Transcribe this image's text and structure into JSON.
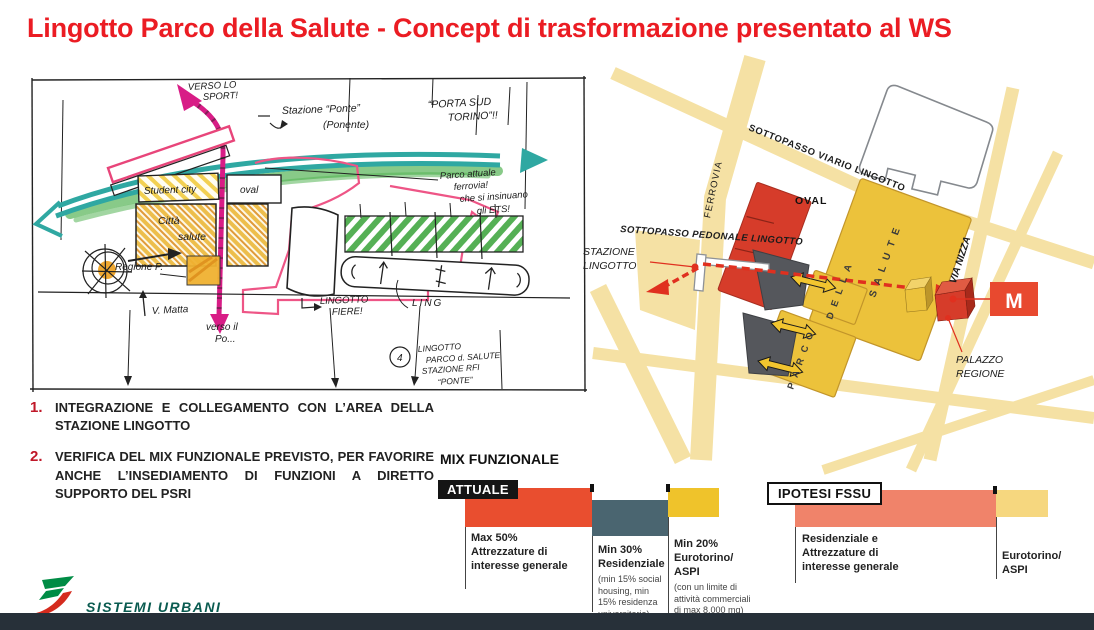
{
  "title": {
    "text": "Lingotto Parco della Salute - Concept di trasformazione presentato al WS",
    "color": "#EB1C23"
  },
  "sketch": {
    "labels": {
      "verso_sport_1": "VERSO LO",
      "verso_sport_2": "SPORT!",
      "stazione_ponte": "Stazione “Ponte”",
      "ponente": "(Ponente)",
      "porta_sud_1": "“PORTA SUD",
      "porta_sud_2": "TORINO”!!",
      "student_city": "Student city",
      "oval": "oval",
      "citta_1": "Città",
      "citta_2": "salute",
      "regione": "Regione P.",
      "parco_note_1": "Parco attuale",
      "parco_note_2": "ferrovia!",
      "parco_note_3": "che si insinuano",
      "parco_note_4": "gli ETS!",
      "v_matta": "V. Matta",
      "verso_po_1": "verso il",
      "verso_po_2": "Po...",
      "fiere_1": "LINGOTTO",
      "fiere_2": "FIERE!",
      "ling": "LING",
      "note_num": "4",
      "note_1": "LINGOTTO",
      "note_2": "PARCO d. SALUTE",
      "note_3": "STAZIONE RFI",
      "note_4": "“PONTE”"
    }
  },
  "map": {
    "labels": {
      "sottopasso_viario": "SOTTOPASSO VIARIO LINGOTTO",
      "ferrovia": "FERROVIA",
      "sottopasso_pedonale": "SOTTOPASSO PEDONALE LINGOTTO",
      "stazione_1": "STAZIONE",
      "stazione_2": "LINGOTTO",
      "oval": "OVAL",
      "salute": "S A L U T E",
      "della": "D E L L A",
      "parco": "P A R C O",
      "via_nizza": "VIA NIZZA",
      "metro": "M",
      "palazzo_1": "PALAZZO",
      "palazzo_2": "REGIONE"
    },
    "colors": {
      "building_yellow": "#ECC23B",
      "road_yellow": "#F5E1A4",
      "block_red": "#D63C2A",
      "block_gray": "#55575C",
      "metro_red": "#E8492F",
      "route_red": "#E0301F"
    }
  },
  "notes": {
    "items": [
      {
        "num": "1.",
        "text": "INTEGRAZIONE E COLLEGAMENTO CON L’AREA DELLA STAZIONE LINGOTTO"
      },
      {
        "num": "2.",
        "text": "VERIFICA DEL MIX FUNZIONALE PREVISTO, PER FAVORIRE ANCHE L’INSEDIAMENTO DI FUNZIONI A DIRETTO SUPPORTO DEL PSRI"
      }
    ]
  },
  "mix": {
    "heading": "MIX FUNZIONALE",
    "attuale": {
      "tag": "ATTUALE",
      "bars": [
        {
          "name": "attrezzature",
          "color": "#E94E2F",
          "value": 50,
          "bold": "Max 50%\nAttrezzature di\ninteresse generale",
          "sub": ""
        },
        {
          "name": "residenziale",
          "color": "#4A6570",
          "value": 30,
          "bold": "Min 30%\nResidenziale",
          "sub": "(min 15% social\nhousing, min\n15% residenza\nuniversitaria)"
        },
        {
          "name": "eurotorino-aspi",
          "color": "#EFC32B",
          "value": 20,
          "bold": "Min 20%\nEurotorino/\nASPI",
          "sub": "(con un limite di\nattività commerciali\ndi max 8.000 mq)"
        }
      ]
    },
    "ipotesi": {
      "tag": "IPOTESI FSSU",
      "bars": [
        {
          "name": "residenziale-attrezzature",
          "color": "#F0836A",
          "value": 80,
          "bold": "Residenziale e\nAttrezzature di\ninteresse generale",
          "sub": ""
        },
        {
          "name": "eurotorino-aspi",
          "color": "#F6D77F",
          "value": 20,
          "bold": "Eurotorino/\nASPI",
          "sub": ""
        }
      ]
    }
  },
  "chart_data": [
    {
      "type": "bar",
      "title": "MIX FUNZIONALE — ATTUALE",
      "categories": [
        "Max 50% Attrezzature di interesse generale",
        "Min 30% Residenziale (min 15% social housing, min 15% residenza universitaria)",
        "Min 20% Eurotorino/ASPI (con un limite di attività commerciali di max 8.000 mq)"
      ],
      "values": [
        50,
        30,
        20
      ],
      "colors": [
        "#E94E2F",
        "#4A6570",
        "#EFC32B"
      ],
      "xlabel": "",
      "ylabel": "",
      "legend": false
    },
    {
      "type": "bar",
      "title": "MIX FUNZIONALE — IPOTESI FSSU",
      "categories": [
        "Residenziale e Attrezzature di interesse generale",
        "Eurotorino/ASPI"
      ],
      "values": [
        80,
        20
      ],
      "colors": [
        "#F0836A",
        "#F6D77F"
      ],
      "xlabel": "",
      "ylabel": "",
      "legend": false
    }
  ],
  "footer": {
    "brand": "SISTEMI URBANI"
  }
}
